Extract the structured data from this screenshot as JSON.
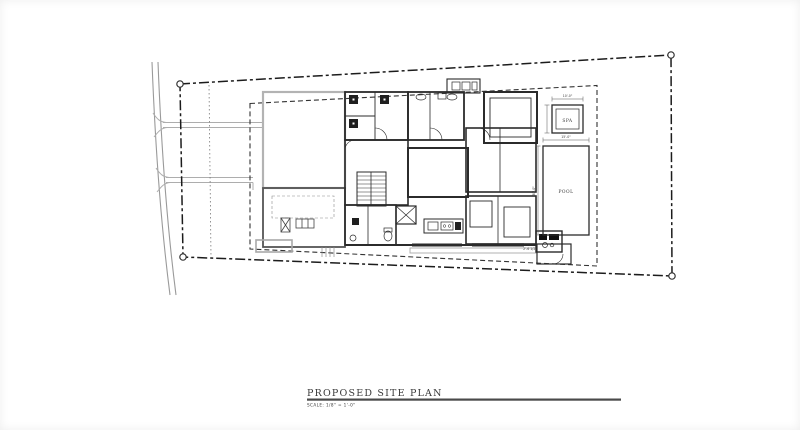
{
  "drawing": {
    "title": "PROPOSED SITE PLAN",
    "scale_note": "SCALE: 1/8\" = 1'-0\"",
    "labels": {
      "pool": "POOL",
      "spa": "SPA"
    },
    "dimensions": {
      "spa_width": "10'-0\"",
      "pool_width": "15'-0\"",
      "pool_length": "30'-0\"",
      "patio_offset": "2'-6 1/2\""
    },
    "colors": {
      "paper": "#ffffff",
      "ink": "#2b2b2b",
      "light_line": "#a8a8a8",
      "boundary": "#1c1c1c"
    }
  }
}
